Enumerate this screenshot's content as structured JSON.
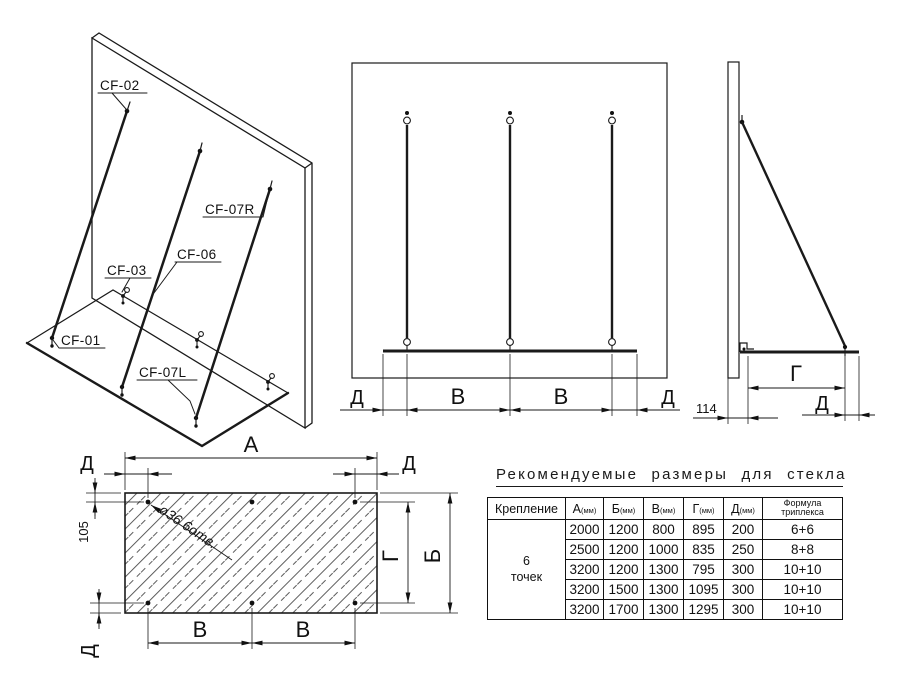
{
  "drawing": {
    "labels": {
      "cf01": "CF-01",
      "cf02": "CF-02",
      "cf03": "CF-03",
      "cf06": "CF-06",
      "cf07l": "CF-07L",
      "cf07r": "CF-07R"
    },
    "dims": {
      "a": "А",
      "b": "Б",
      "v": "В",
      "g": "Г",
      "d": "Д",
      "n105": "105",
      "n114": "114",
      "holes_note": "ø36  6отв."
    }
  },
  "table": {
    "title": "Рекомендуемые размеры для стекла",
    "header": {
      "mount": "Крепление",
      "letters": [
        "А",
        "Б",
        "В",
        "Г",
        "Д"
      ],
      "unit": "(мм)",
      "formula": [
        "Формула",
        "триплекса"
      ]
    },
    "mount_value": [
      "6",
      "точек"
    ],
    "rows": [
      [
        "2000",
        "1200",
        "800",
        "895",
        "200",
        "6+6"
      ],
      [
        "2500",
        "1200",
        "1000",
        "835",
        "250",
        "8+8"
      ],
      [
        "3200",
        "1200",
        "1300",
        "795",
        "300",
        "10+10"
      ],
      [
        "3200",
        "1500",
        "1300",
        "1095",
        "300",
        "10+10"
      ],
      [
        "3200",
        "1700",
        "1300",
        "1295",
        "300",
        "10+10"
      ]
    ]
  }
}
